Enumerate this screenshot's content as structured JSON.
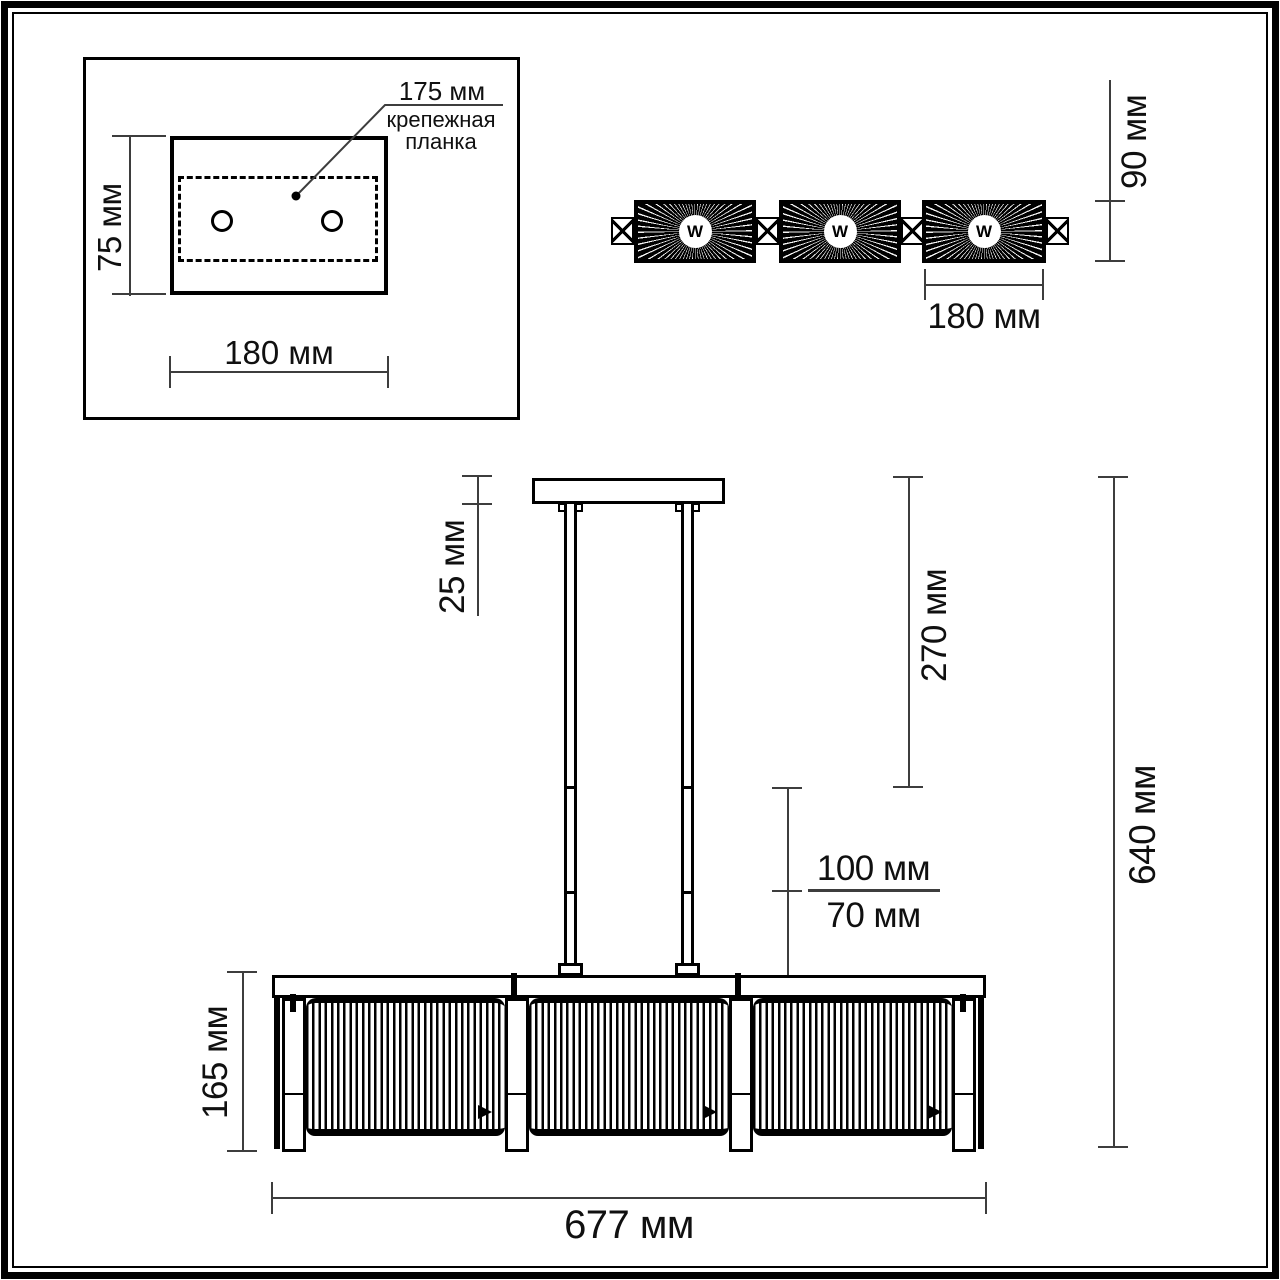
{
  "drawing": {
    "units_note": "мм",
    "colors": {
      "ink": "#000000",
      "dim_line": "#3d3d3d",
      "background": "#ffffff"
    },
    "mounting_panel": {
      "pitch_label": "175 мм",
      "caption": [
        "крепежная",
        "планка"
      ],
      "height_label": "75 мм",
      "width_label": "180 мм"
    },
    "top_view": {
      "lamp_symbol": "W",
      "shade_count": 3,
      "height_label": "90 мм",
      "width_label": "180 мм"
    },
    "front_view": {
      "canopy_label": "25 мм",
      "rod_label": "270 мм",
      "suspension_upper_label": "100 мм",
      "suspension_lower_label": "70 мм",
      "overall_height_label": "640 мм",
      "shade_height_label": "165 мм",
      "overall_width_label": "677 мм"
    }
  }
}
